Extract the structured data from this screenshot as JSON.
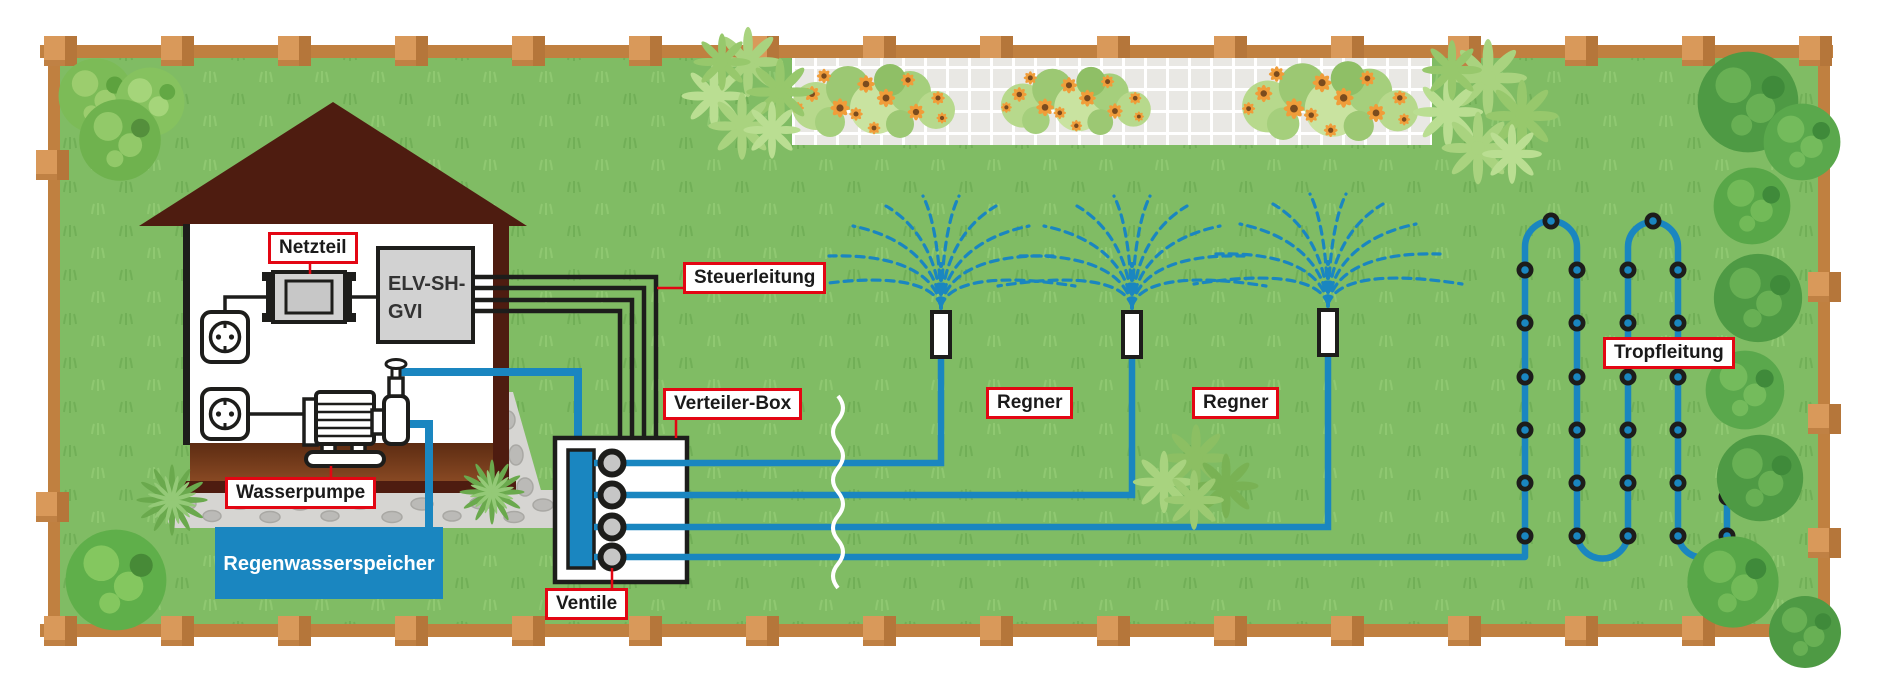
{
  "diagram": {
    "labels": {
      "netzteil": "Netzteil",
      "steuerleitung": "Steuerleitung",
      "verteiler_box": "Verteiler-Box",
      "ventile": "Ventile",
      "wasserpumpe": "Wasserpumpe",
      "regner_left": "Regner",
      "regner_right": "Regner",
      "tropfleitung": "Tropfleitung"
    },
    "controller": {
      "line1": "ELV-SH-",
      "line2": "GVI"
    },
    "tank": {
      "label": "Regenwasserspeicher"
    },
    "icons": [
      "house",
      "roof",
      "power-outlet",
      "power-supply",
      "smart-home-gateway",
      "water-pump",
      "rain-water-tank",
      "distribution-box",
      "valve",
      "manifold",
      "sprinkler",
      "water-spray",
      "drip-line",
      "drip-emitter",
      "fence",
      "fence-post",
      "bush",
      "leaf-bush",
      "spiky-plant",
      "flower-bed",
      "flower",
      "grass",
      "stone-path",
      "pipe-break"
    ]
  },
  "colors": {
    "label_border": "#e30613",
    "label_bg": "#ffffff",
    "label_text": "#1a1a1a",
    "pipe_blue": "#1a86c0",
    "tank_blue": "#1a86c0",
    "line_black": "#1d1d1b",
    "grass_green": "#80bc64",
    "grass_tuft": "#6cab52",
    "roof_brown": "#4e1c10",
    "floor_brown": "#6e3a1a",
    "fence_rail": "#c08040",
    "fence_post": "#d9995a",
    "fence_post_shade": "#b5763a",
    "device_gray": "#d2d2d2",
    "valve_gray": "#c6c6c6",
    "paver_gray": "#e9e8e4",
    "stone_gray": "#d6d5d2",
    "stone_dark": "#bbbab7",
    "bush_dark": "#4e9a44",
    "bush_dark_light": "#68b054",
    "bush_light": "#7cbb57",
    "bush_light_hl": "#9ccd6e",
    "leaf_green": "#a9d37f",
    "flower_orange": "#f09d3a",
    "flower_center": "#7a4b1e"
  }
}
